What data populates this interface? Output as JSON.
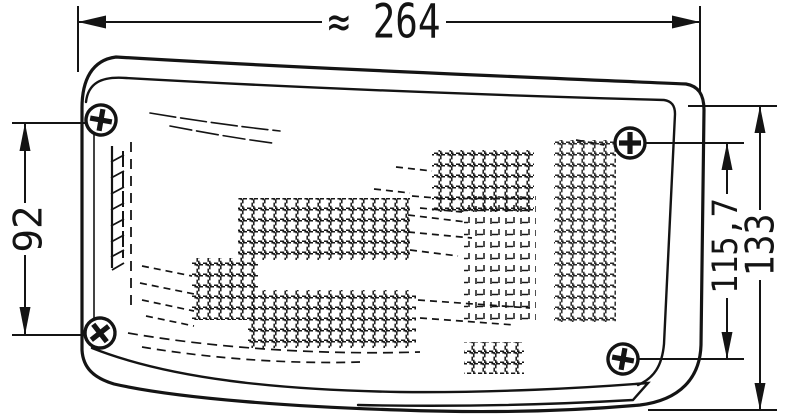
{
  "drawing": {
    "kind": "technical-dimension-drawing",
    "subject": "wrap-around lamp with lens mesh texture and four phillips screws",
    "background_color": "#ffffff",
    "ink_color": "#141414",
    "dimensions": {
      "width": {
        "value": "≈ 264",
        "position": "top"
      },
      "mounting_height": {
        "value": "92",
        "position": "left"
      },
      "inner_height": {
        "value": "115,7",
        "position": "right-inner"
      },
      "total_height": {
        "value": "133",
        "position": "right-outer"
      }
    },
    "icons": {
      "screw": "phillips-screw-icon"
    },
    "screw_count": 4
  }
}
